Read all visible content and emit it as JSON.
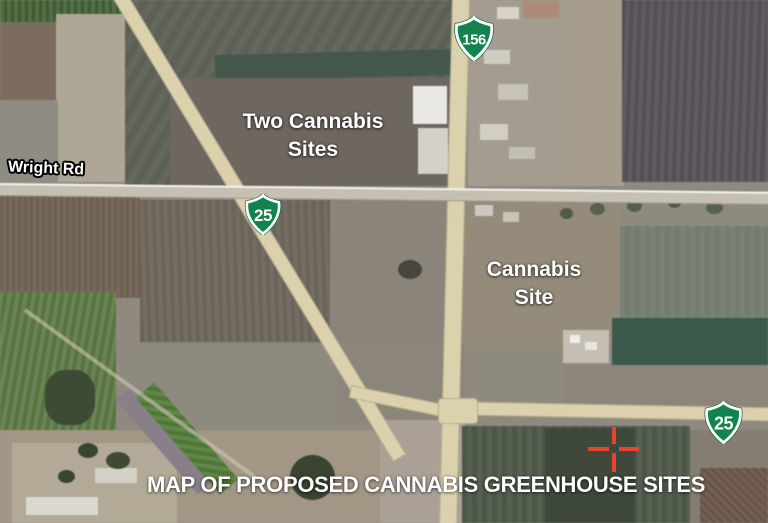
{
  "map": {
    "labels": {
      "wright_rd": "Wright Rd",
      "two_cannabis_sites": "Two Cannabis Sites",
      "cannabis_site": "Cannabis Site",
      "caption": "MAP OF PROPOSED CANNABIS GREENHOUSE SITES"
    },
    "shields": {
      "hwy156": "156",
      "hwy25_upper": "25",
      "hwy25_lower": "25"
    },
    "marker": {
      "type": "crosshair",
      "color": "#e8432e"
    },
    "colors": {
      "shield_green": "#12824e",
      "road_tan": "#dcd2aa",
      "label_white": "#ffffff"
    }
  }
}
